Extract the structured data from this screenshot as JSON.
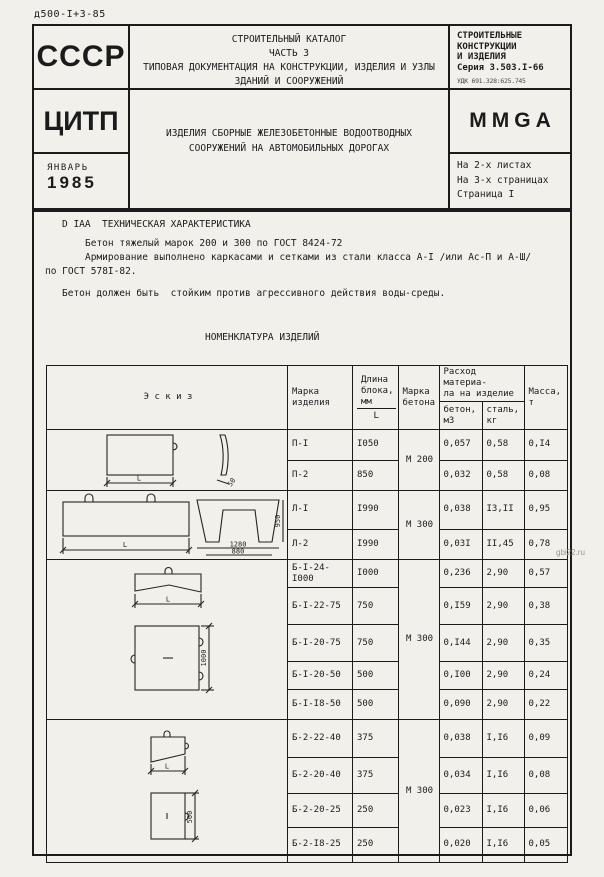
{
  "page": {
    "doc_code": "д500-I+3-85",
    "watermark": "gbi22.ru"
  },
  "header": {
    "ussr": "СССР",
    "citp": "ЦИТП",
    "month": "ЯНВАРЬ",
    "year": "1985",
    "catalog": "СТРОИТЕЛЬНЫЙ КАТАЛОГ\nЧАСТЬ 3\nТИПОВАЯ ДОКУМЕНТАЦИЯ НА КОНСТРУКЦИИ, ИЗДЕЛИЯ И УЗЛЫ\nЗДАНИЙ И СООРУЖЕНИЙ",
    "subject": "ИЗДЕЛИЯ СБОРНЫЕ ЖЕЛЕЗОБЕТОННЫЕ ВОДООТВОДНЫХ\nСООРУЖЕНИЙ НА АВТОМОБИЛЬНЫХ ДОРОГАХ",
    "series": "СТРОИТЕЛЬНЫЕ\nКОНСТРУКЦИИ\nИ ИЗДЕЛИЯ\nСерия 3.503.I-66",
    "udc": "УДК 691.328:625.745",
    "code": "MMGA",
    "sheets": "На 2-х листах\nНа 3-х страницах\nСтраница I"
  },
  "tech": {
    "heading": "D IAA  ТЕХНИЧЕСКАЯ ХАРАКТЕРИСТИКА",
    "para1": "Бетон тяжелый марок 200 и 300 по ГОСТ 8424-72",
    "para2": "Армирование выполнено каркасами и сетками из стали класса А-I /или Ас-П и А-Ш/",
    "para2_cont": "по ГОСТ 578I-82.",
    "para3": "Бетон должен быть  стойким против агрессивного действия воды-среды."
  },
  "nomenclature_title": "НОМЕНКЛАТУРА ИЗДЕЛИЙ",
  "table": {
    "headers": {
      "sketch": "Э с к и з",
      "mark": "Марка\nизделия",
      "length": "Длина\nблока,\nмм",
      "length_sub": "L",
      "concrete_grade": "Марка\nбетона",
      "consumption": "Расход материа-\nла на изделие",
      "sub_concrete": "бетон,\nм3",
      "sub_steel": "сталь,\nкг",
      "mass": "Масса,\nт"
    },
    "grades": [
      "М 200",
      "М 300",
      "М 300",
      "М 300"
    ],
    "rows": [
      {
        "mark": "П-I",
        "length": "I050",
        "concrete": "0,057",
        "steel": "0,58",
        "mass": "0,I4"
      },
      {
        "mark": "П-2",
        "length": "850",
        "concrete": "0,032",
        "steel": "0,58",
        "mass": "0,08"
      },
      {
        "mark": "Л-I",
        "length": "I990",
        "concrete": "0,038",
        "steel": "I3,II",
        "mass": "0,95"
      },
      {
        "mark": "Л-2",
        "length": "I990",
        "concrete": "0,03I",
        "steel": "II,45",
        "mass": "0,78"
      },
      {
        "mark": "Б-I-24-I000",
        "length": "I000",
        "concrete": "0,236",
        "steel": "2,90",
        "mass": "0,57"
      },
      {
        "mark": "Б-I-22-75",
        "length": "750",
        "concrete": "0,I59",
        "steel": "2,90",
        "mass": "0,38"
      },
      {
        "mark": "Б-I-20-75",
        "length": "750",
        "concrete": "0,I44",
        "steel": "2,90",
        "mass": "0,35"
      },
      {
        "mark": "Б-I-20-50",
        "length": "500",
        "concrete": "0,I00",
        "steel": "2,90",
        "mass": "0,24"
      },
      {
        "mark": "Б-I-I8-50",
        "length": "500",
        "concrete": "0,090",
        "steel": "2,90",
        "mass": "0,22"
      },
      {
        "mark": "Б-2-22-40",
        "length": "375",
        "concrete": "0,038",
        "steel": "I,I6",
        "mass": "0,09"
      },
      {
        "mark": "Б-2-20-40",
        "length": "375",
        "concrete": "0,034",
        "steel": "I,I6",
        "mass": "0,08"
      },
      {
        "mark": "Б-2-20-25",
        "length": "250",
        "concrete": "0,023",
        "steel": "I,I6",
        "mass": "0,06"
      },
      {
        "mark": "Б-2-I8-25",
        "length": "250",
        "concrete": "0,020",
        "steel": "I,I6",
        "mass": "0,05"
      }
    ],
    "sketches": {
      "p": {
        "dim_length": "L",
        "dim_thickness": "50"
      },
      "l": {
        "dim_length": "L",
        "dim_width_outer": "1280",
        "dim_width_inner": "880",
        "dim_height": "950"
      },
      "b1": {
        "dim_length": "L",
        "dim_height": "1000"
      },
      "b2": {
        "dim_length": "L",
        "dim_height": "500"
      }
    }
  }
}
